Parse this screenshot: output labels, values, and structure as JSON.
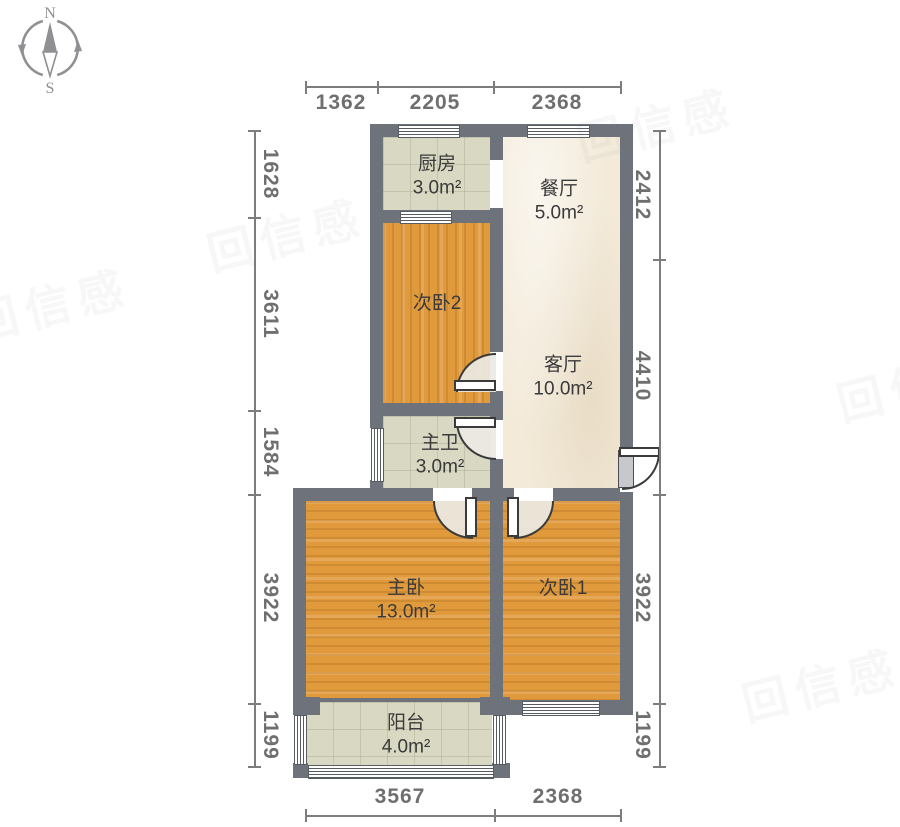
{
  "compass": {
    "north": "N",
    "south": "S"
  },
  "rooms": {
    "kitchen": {
      "name": "厨房",
      "area": "3.0m²"
    },
    "dining": {
      "name": "餐厅",
      "area": "5.0m²"
    },
    "bedroom2": {
      "name": "次卧2",
      "area": ""
    },
    "living": {
      "name": "客厅",
      "area": "10.0m²"
    },
    "bath": {
      "name": "主卫",
      "area": "3.0m²"
    },
    "master": {
      "name": "主卧",
      "area": "13.0m²"
    },
    "bedroom1": {
      "name": "次卧1",
      "area": ""
    },
    "balcony": {
      "name": "阳台",
      "area": "4.0m²"
    }
  },
  "dims": {
    "top": [
      "1362",
      "2205",
      "2368"
    ],
    "left": [
      "1628",
      "3611",
      "1584",
      "3922",
      "1199"
    ],
    "right": [
      "2412",
      "4410",
      "3922",
      "1199"
    ],
    "bottom": [
      "3567",
      "2368"
    ]
  },
  "watermark": "回信感",
  "colors": {
    "wall": "#6e737b",
    "wood_floor": "#e09a3c",
    "tile_floor": "#d9d8c2",
    "plaster_floor": "#f3ead9",
    "dimension_text": "#6f6f6f",
    "room_label_text": "#3a3a3a"
  }
}
